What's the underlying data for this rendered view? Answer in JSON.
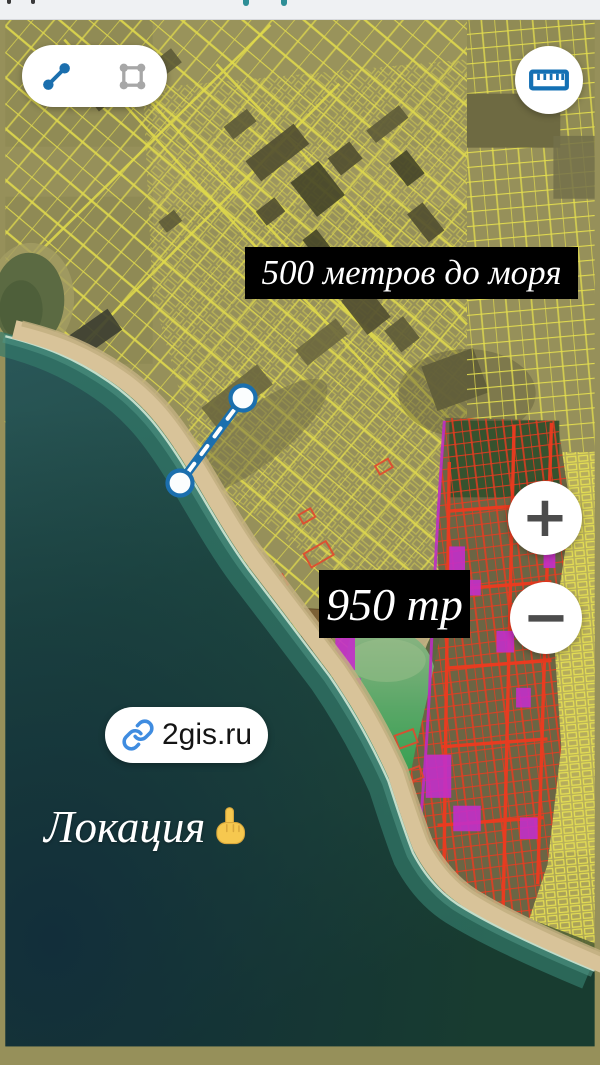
{
  "top_bar": {
    "background": "#eff1f3"
  },
  "measure_toolbar": {
    "distance_tool_icon": "measure-distance-icon",
    "area_tool_icon": "measure-area-icon",
    "active_color": "#1b6fae",
    "inactive_color": "#a7a7a7"
  },
  "ruler_button": {
    "icon": "ruler-icon",
    "color": "#1470b4"
  },
  "map_labels": {
    "distance": "500 метров до моря",
    "price": "950 тр"
  },
  "zoom_controls": {
    "zoom_in": "+",
    "zoom_out": "−"
  },
  "link_badge": {
    "label": "2gis.ru",
    "icon": "link-icon",
    "icon_color": "#3f8ce0"
  },
  "location_caption": {
    "text": "Локация",
    "emoji": "👆"
  },
  "measurement": {
    "line_color": "#1b6fae",
    "endpoints": [
      {
        "x": 243,
        "y": 398
      },
      {
        "x": 180,
        "y": 483
      }
    ]
  },
  "map_colors": {
    "sea": "#1e443a",
    "land": "#96905a",
    "parcel_yellow": "#dcd64d",
    "parcel_red": "#ee3a1f",
    "parcel_magenta": "#c02ec6",
    "lake_green": "#3aa64f",
    "beach": "#d8c399"
  }
}
